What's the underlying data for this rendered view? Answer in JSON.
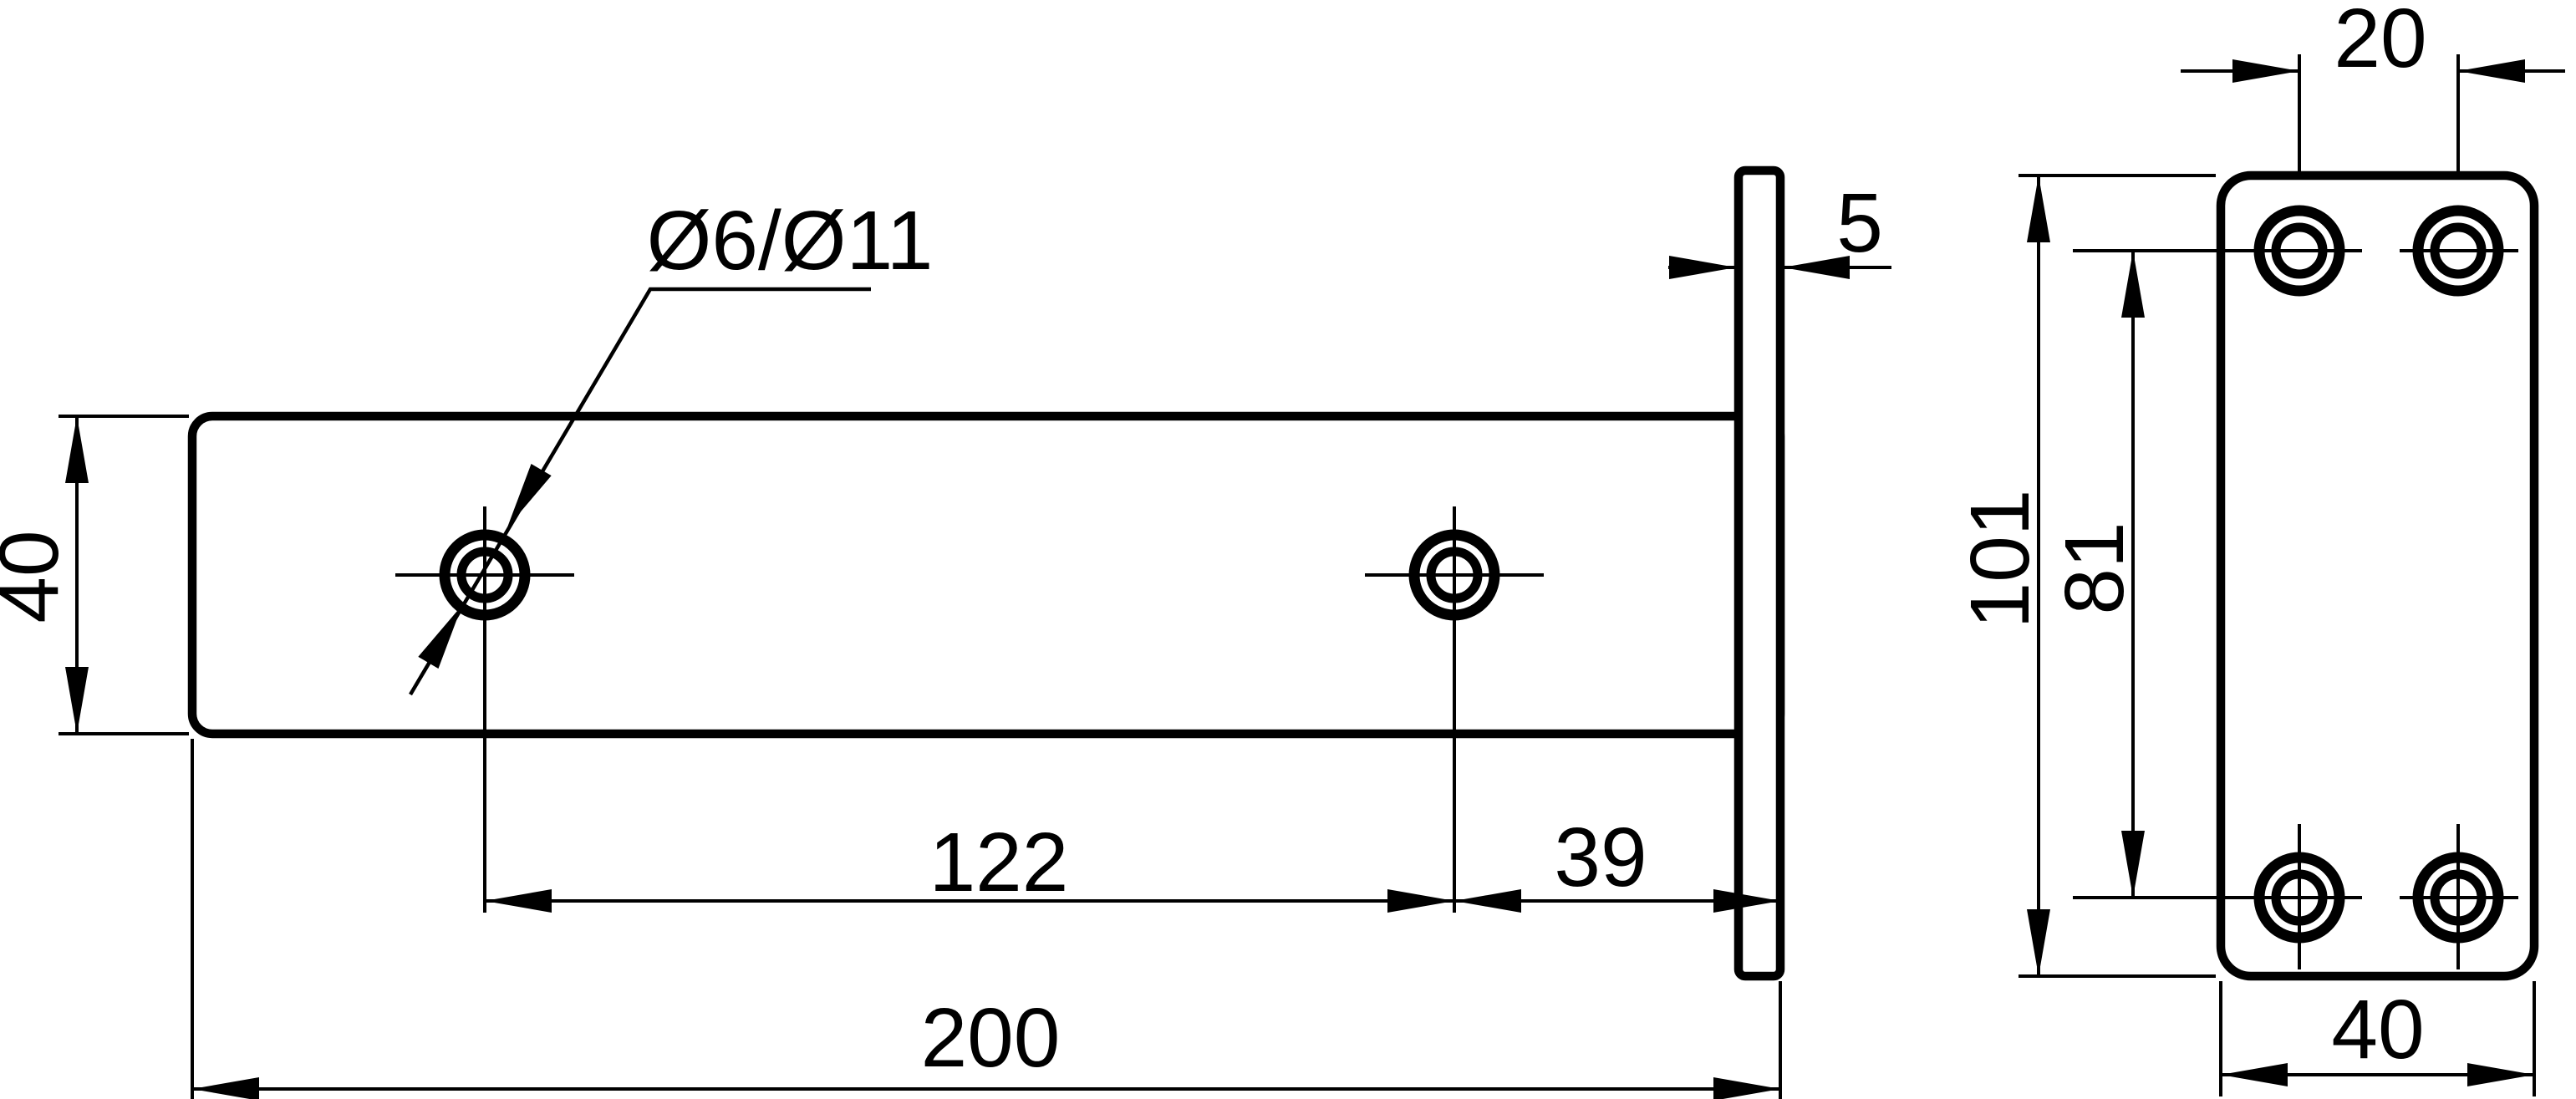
{
  "drawing": {
    "type": "technical-drawing",
    "line_color": "#000000",
    "background_color": "#ffffff",
    "side_view": {
      "height": "40",
      "hole_note": "Ø6/Ø11",
      "plate_thickness": "5",
      "hole_spacing": "122",
      "hole_to_end": "39",
      "total_length": "200"
    },
    "front_view": {
      "hole_spacing_horizontal": "20",
      "height": "101",
      "hole_spacing_vertical": "81",
      "width": "40"
    }
  }
}
